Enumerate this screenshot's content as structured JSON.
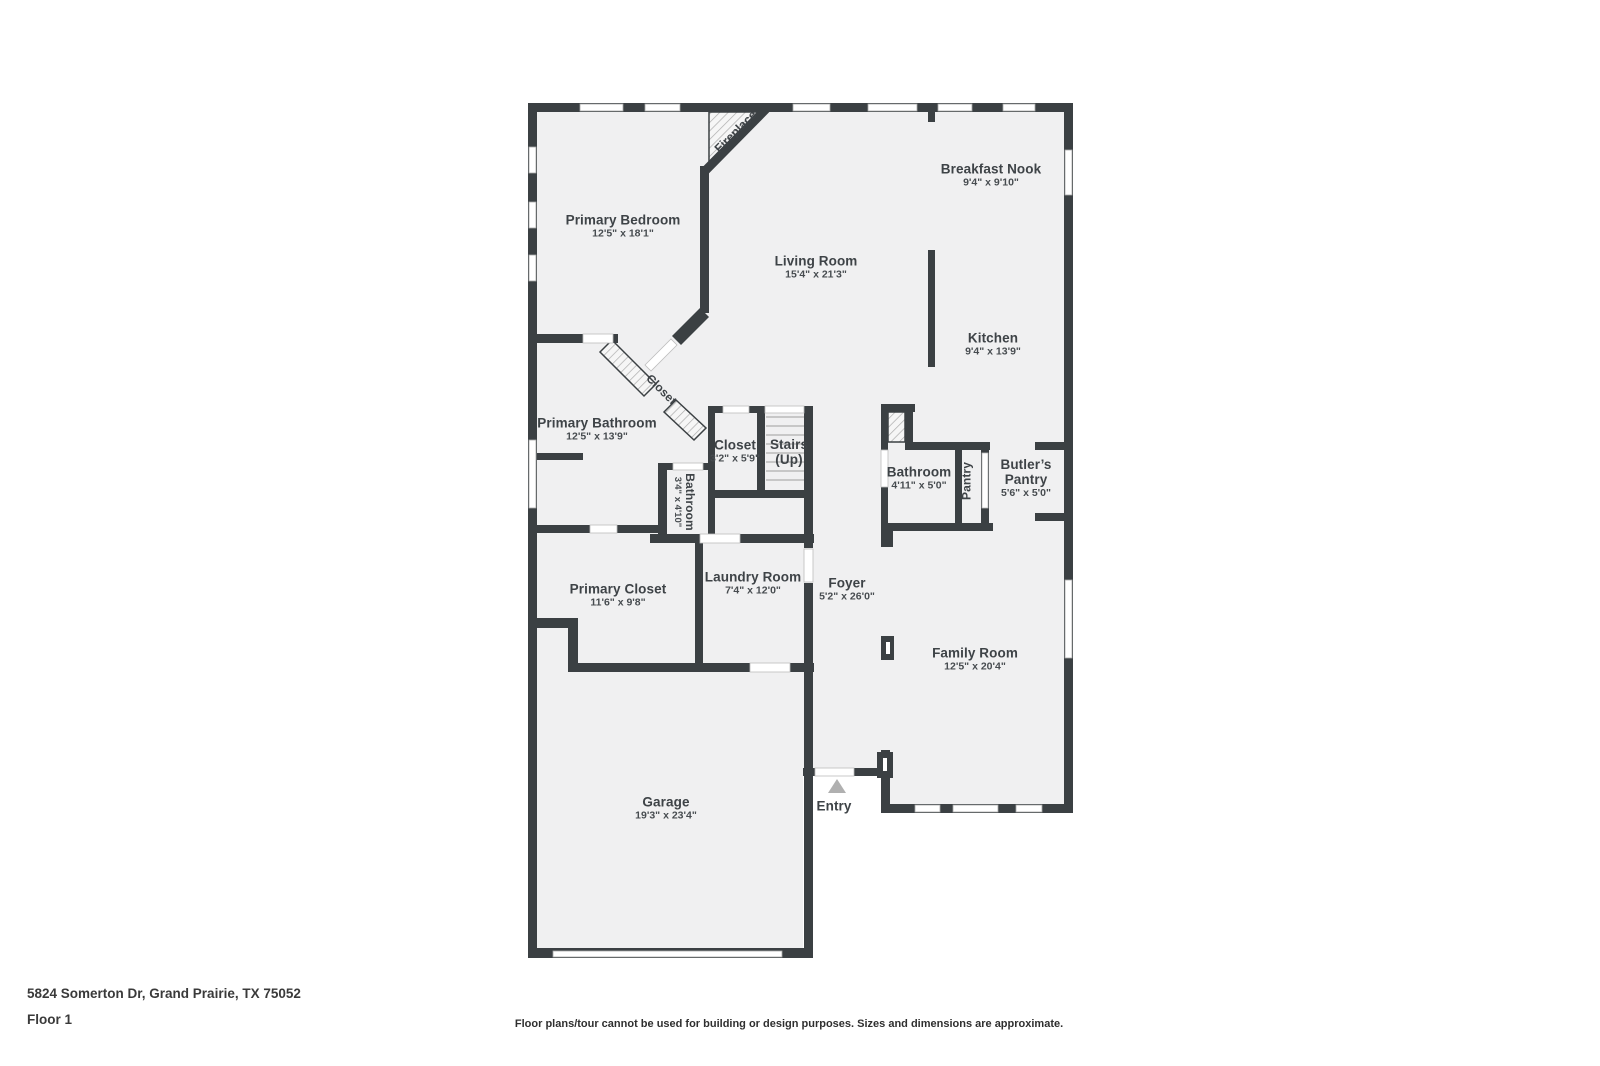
{
  "plan": {
    "address": "5824 Somerton Dr, Grand Prairie, TX 75052",
    "floor_label": "Floor 1",
    "disclaimer": "Floor plans/tour cannot be used for building or design purposes. Sizes and dimensions are approximate.",
    "colors": {
      "wall": "#3b4043",
      "floor": "#f0f0f1",
      "hatch_line": "#adadad",
      "entry_marker": "#b0b0b0",
      "stair_tread": "#c7c7c7"
    },
    "labels": [
      {
        "id": "primary-bedroom",
        "name": "Primary Bedroom",
        "dims": "12'5\" x 18'1\"",
        "x": 623,
        "y": 227
      },
      {
        "id": "living-room",
        "name": "Living Room",
        "dims": "15'4\" x 21'3\"",
        "x": 816,
        "y": 268
      },
      {
        "id": "breakfast-nook",
        "name": "Breakfast Nook",
        "dims": "9'4\" x 9'10\"",
        "x": 991,
        "y": 176
      },
      {
        "id": "kitchen",
        "name": "Kitchen",
        "dims": "9'4\" x 13'9\"",
        "x": 993,
        "y": 345
      },
      {
        "id": "primary-bathroom",
        "name": "Primary Bathroom",
        "dims": "12'5\" x 13'9\"",
        "x": 597,
        "y": 430
      },
      {
        "id": "closet-hall",
        "name": "Closet",
        "dims": "3'2\" x 5'9\"",
        "x": 735,
        "y": 452
      },
      {
        "id": "stairs",
        "name": "Stairs",
        "dims": "(Up)",
        "x": 789,
        "y": 452,
        "bigsub": true
      },
      {
        "id": "bathroom-down",
        "name": "Bathroom",
        "dims": "4'11\" x 5'0\"",
        "x": 919,
        "y": 479
      },
      {
        "id": "butlers-pantry",
        "name": "Butler’s Pantry",
        "dims": "5'6\" x 5'0\"",
        "x": 1026,
        "y": 479,
        "wrap": true
      },
      {
        "id": "laundry-room",
        "name": "Laundry Room",
        "dims": "7'4\" x 12'0\"",
        "x": 753,
        "y": 584
      },
      {
        "id": "foyer",
        "name": "Foyer",
        "dims": "5'2\" x 26'0\"",
        "x": 847,
        "y": 590
      },
      {
        "id": "primary-closet",
        "name": "Primary Closet",
        "dims": "11'6\" x 9'8\"",
        "x": 618,
        "y": 596
      },
      {
        "id": "family-room",
        "name": "Family Room",
        "dims": "12'5\" x 20'4\"",
        "x": 975,
        "y": 660
      },
      {
        "id": "garage",
        "name": "Garage",
        "dims": "19'3\" x 23'4\"",
        "x": 666,
        "y": 809
      },
      {
        "id": "entry",
        "name": "Entry",
        "x": 834,
        "y": 806
      },
      {
        "id": "fireplace",
        "name": "Fireplace",
        "x": 736,
        "y": 132,
        "rot": -45,
        "small": true
      },
      {
        "id": "closet-diagonal",
        "name": "Closet",
        "x": 661,
        "y": 390,
        "rot": 45,
        "small": true
      },
      {
        "id": "bathroom-small",
        "name": "Bathroom",
        "dims": "3'4\" x 4'10\"",
        "x": 683,
        "y": 502,
        "rot": 90,
        "small": true
      },
      {
        "id": "pantry",
        "name": "Pantry",
        "x": 967,
        "y": 481,
        "rot": -90,
        "small": true
      }
    ]
  }
}
